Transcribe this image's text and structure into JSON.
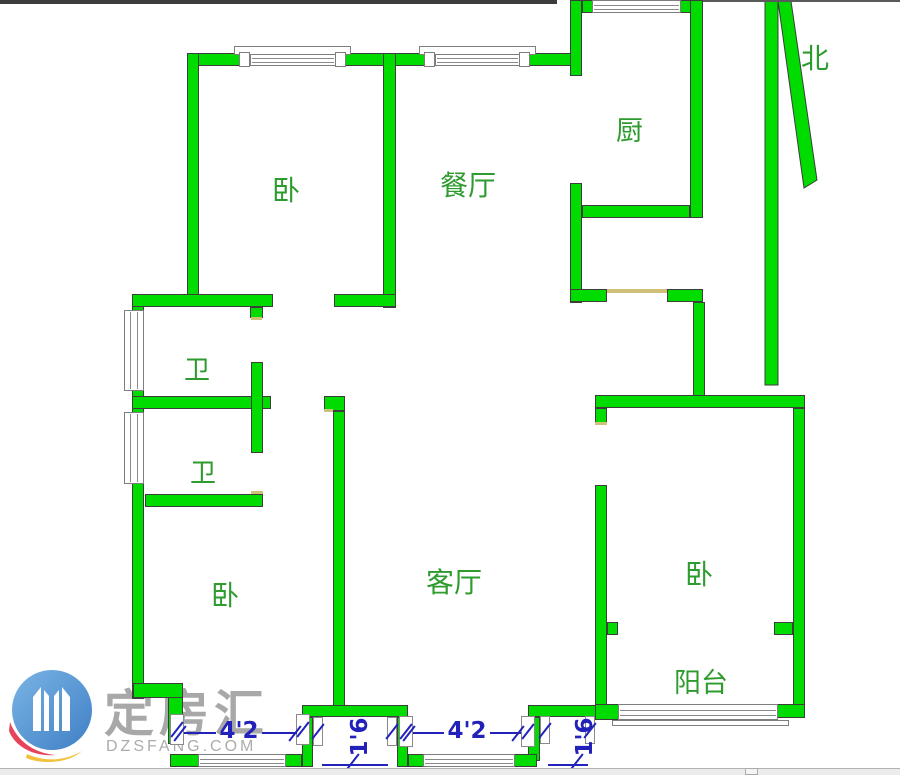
{
  "floor_plan": {
    "rooms": {
      "bedroom_top": "卧",
      "dining_room": "餐厅",
      "kitchen": "厨",
      "bathroom_upper": "卫",
      "bathroom_lower": "卫",
      "bedroom_left": "卧",
      "living_room": "客厅",
      "bedroom_right": "卧",
      "balcony": "阳台"
    },
    "compass": {
      "north_label": "北"
    },
    "dimensions": [
      {
        "value": "4'2",
        "orientation": "horizontal"
      },
      {
        "value": "1'6",
        "orientation": "vertical"
      },
      {
        "value": "4'2",
        "orientation": "horizontal"
      },
      {
        "value": "1'6",
        "orientation": "vertical"
      }
    ]
  },
  "watermark": {
    "brand": "定房汇",
    "website": "DZSFANG.COM"
  },
  "colors": {
    "wall_fill": "#00DC00",
    "wall_outline": "#3D3D3D",
    "room_label_green": "#2E9B2E",
    "dimension_blue": "#2222BB",
    "door_threshold_tan": "#CFC07A",
    "watermark_gray": "#A8A8A8",
    "logo_blue": "#4A8FD4",
    "logo_red": "#E8435C",
    "logo_yellow": "#F2C23E"
  }
}
